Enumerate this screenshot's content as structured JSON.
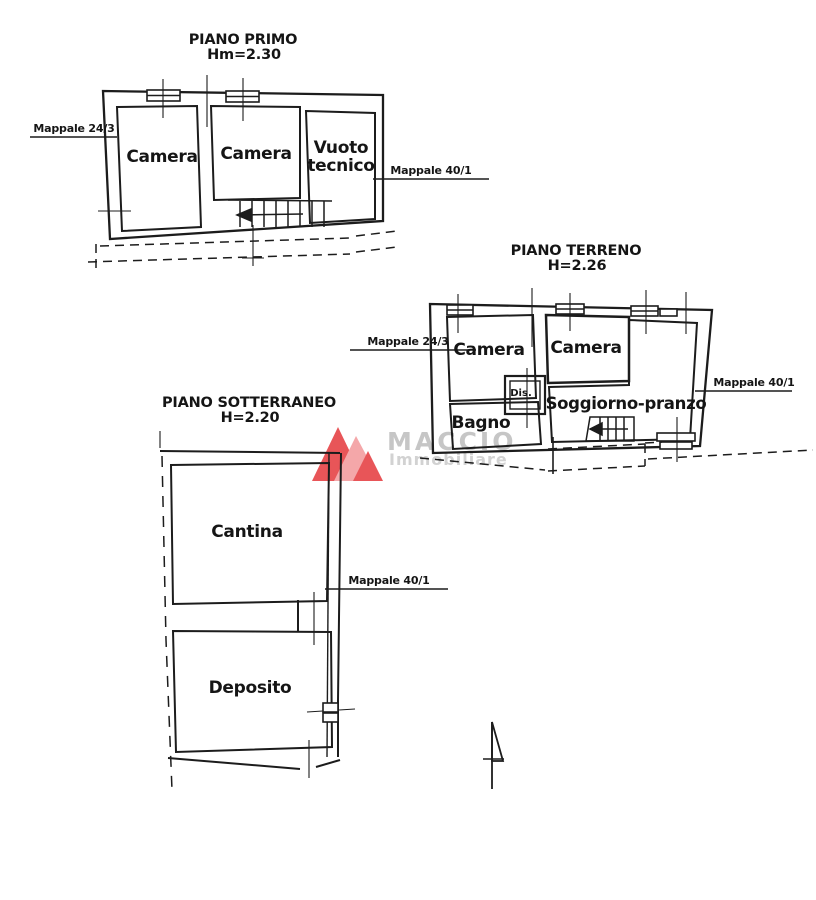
{
  "plans": [
    {
      "id": "piano-primo",
      "title": "PIANO PRIMO",
      "height_label": "Hm=2.30",
      "rooms": [
        "Camera",
        "Camera",
        "Vuoto tecnico"
      ],
      "mappale_left": "Mappale 24/3",
      "mappale_right": "Mappale 40/1"
    },
    {
      "id": "piano-terreno",
      "title": "PIANO TERRENO",
      "height_label": "H=2.26",
      "rooms": [
        "Camera",
        "Camera",
        "Bagno",
        "Dis.",
        "Soggiorno-pranzo"
      ],
      "mappale_left": "Mappale 24/3",
      "mappale_right": "Mappale 40/1"
    },
    {
      "id": "piano-sotterraneo",
      "title": "PIANO SOTTERRANEO",
      "height_label": "H=2.20",
      "rooms": [
        "Cantina",
        "Deposito"
      ],
      "mappale_right": "Mappale 40/1"
    }
  ],
  "watermark": {
    "brand": "MACCIO",
    "subtitle": "Immobiliare"
  },
  "icons": {
    "north_arrow": "north-arrow-icon",
    "stair_arrow": "stair-direction-arrow-icon",
    "logo": "maccio-mountains-logo-icon"
  },
  "colors": {
    "line": "#1c1c1c",
    "logo_dark": "#e85558",
    "logo_light": "#f4a7a9",
    "watermark_text": "#c6c6c6",
    "watermark_text2": "#d2d2d2"
  }
}
